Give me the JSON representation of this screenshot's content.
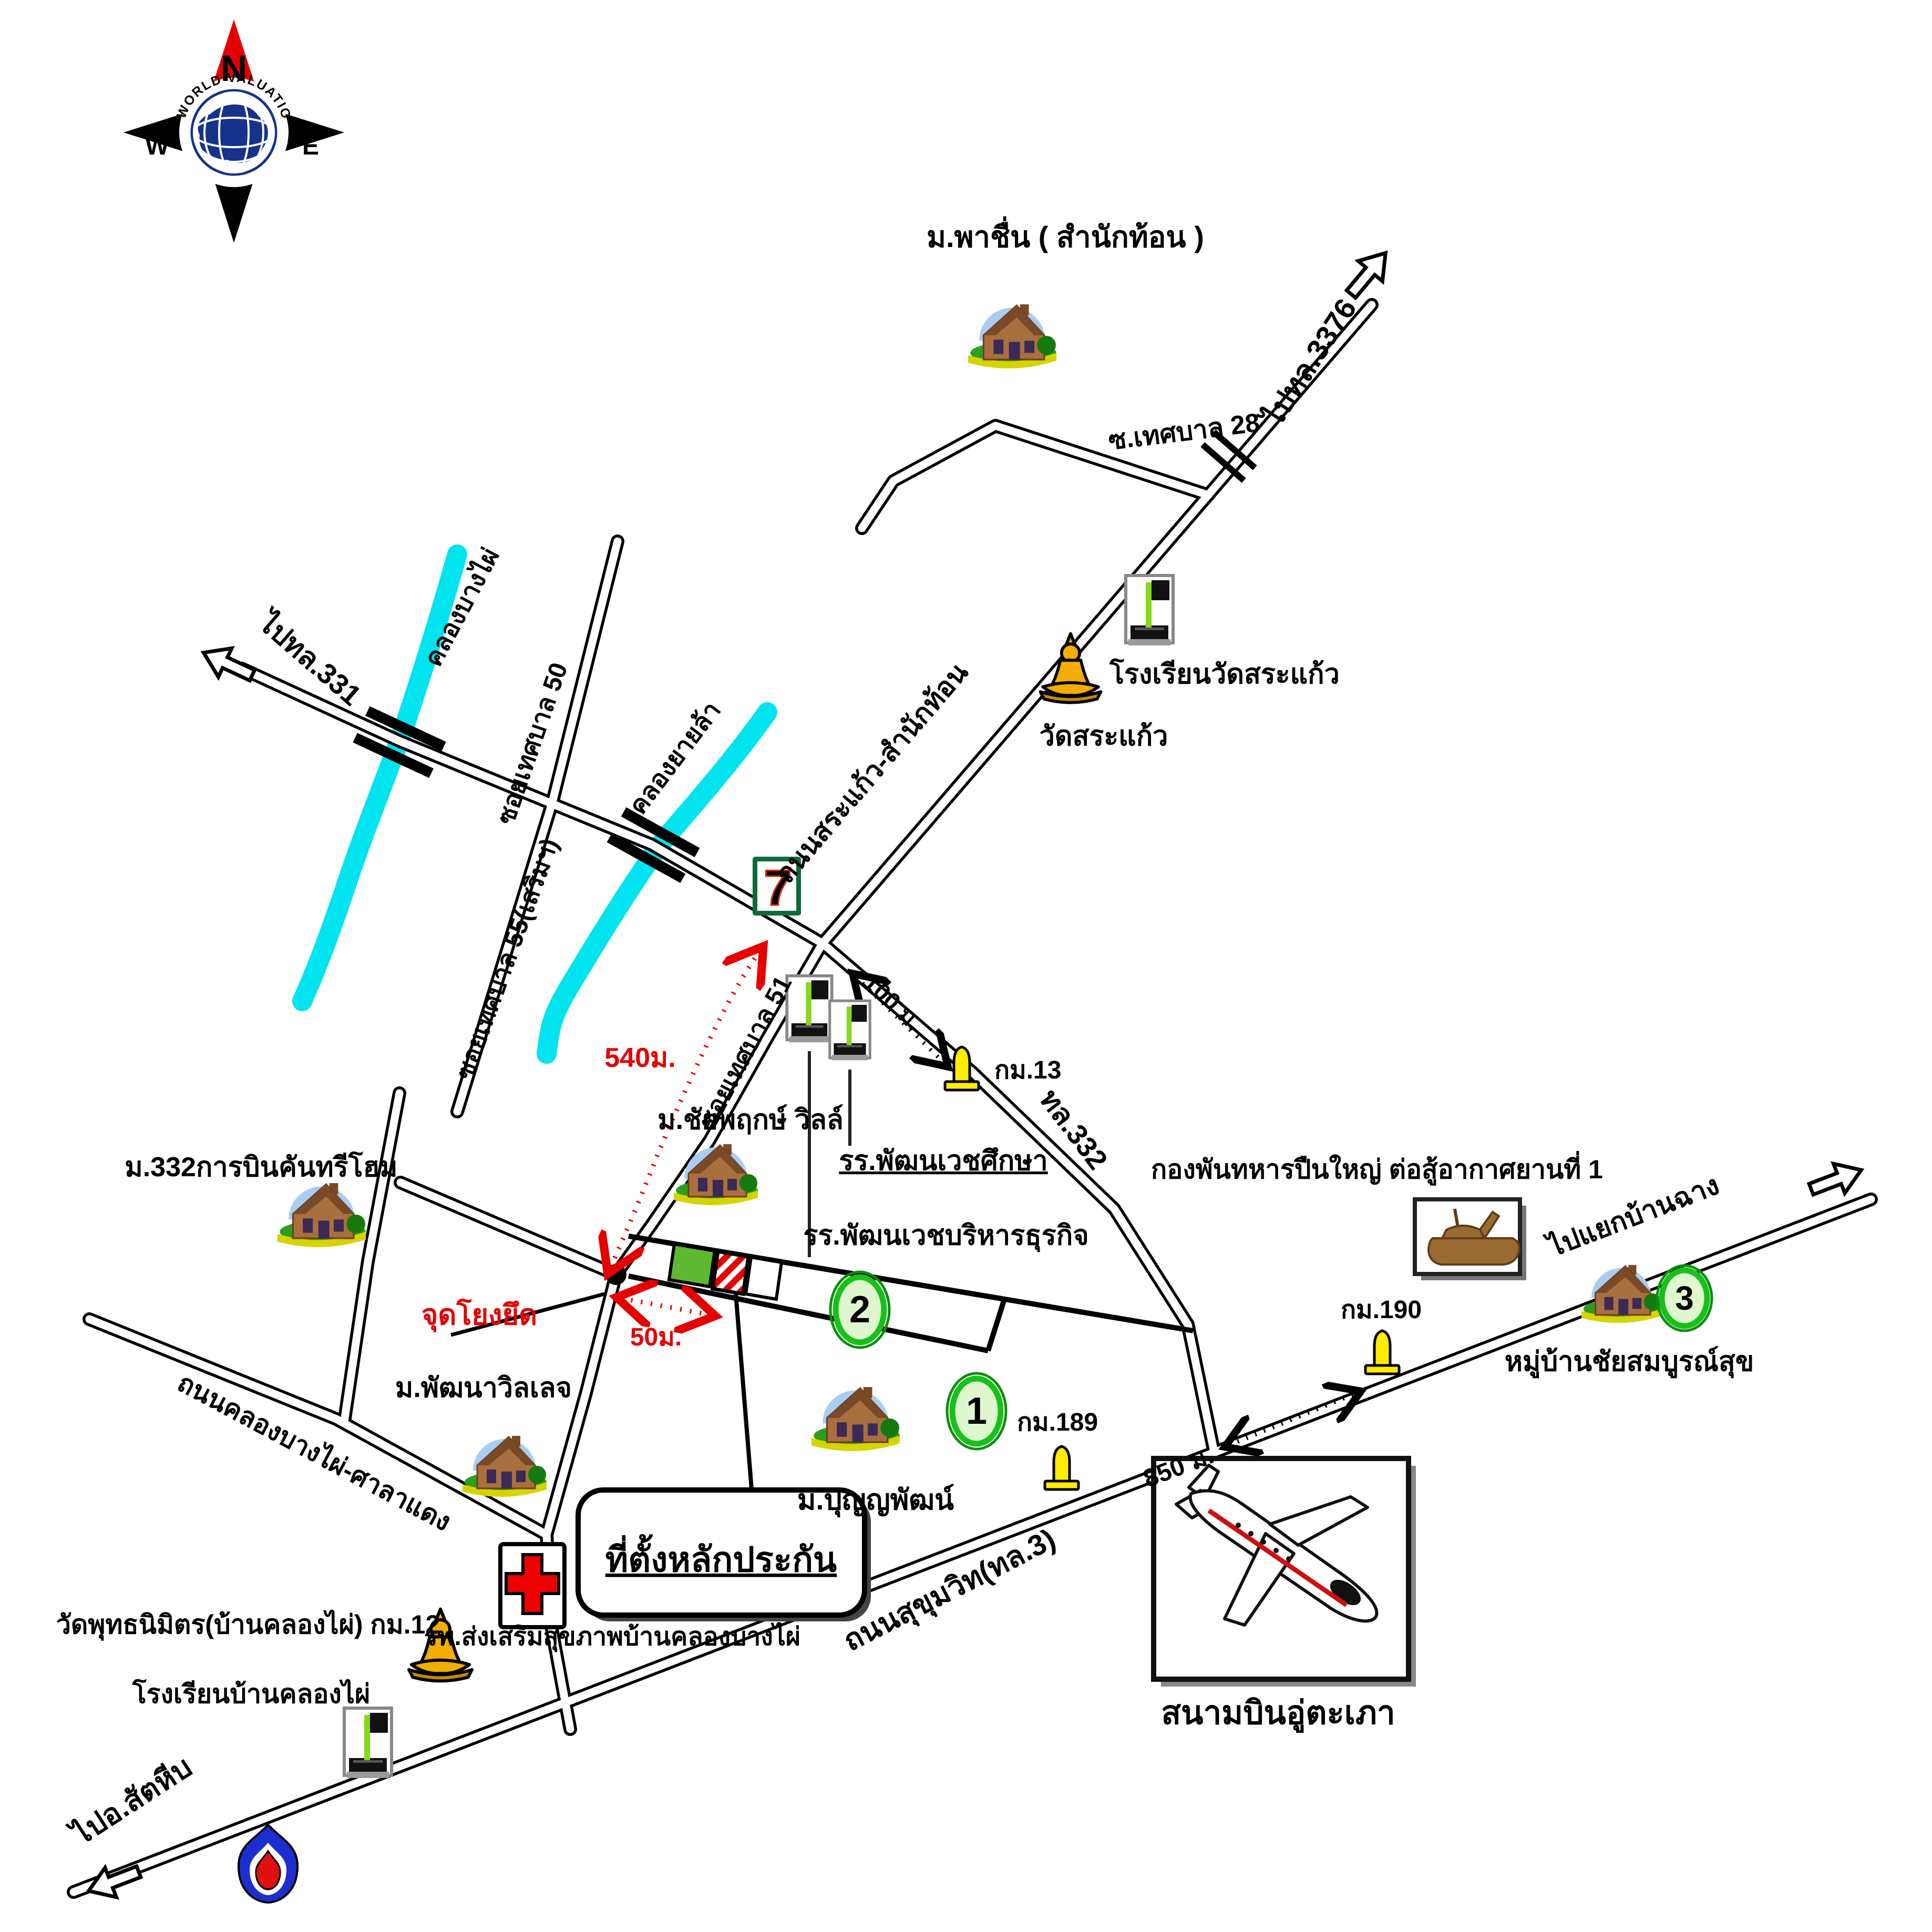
{
  "compass": {
    "north": "N",
    "east": "E",
    "south": "S",
    "west": "W",
    "brand": "WORLD VALUATION"
  },
  "places": {
    "pachuen": "ม.พาชื่น ( สำนักท้อน )",
    "school_wat_sakaeo": "โรงเรียนวัดสระแก้ว",
    "wat_sakaeo": "วัดสระแก้ว",
    "chaiyapruek_ville": "ม.ชัยพฤกษ์ วิลล์",
    "pattanawet_suksa": "รร.พัฒนเวชศึกษา",
    "pattanawet_biz": "รร.พัฒนเวชบริหารธุรกิจ",
    "m332_country_home": "ม.332การบินคันทรีโฮม",
    "punyapat": "ม.ปุญญพัฒน์",
    "artillery_batt": "กองพันทหารปืนใหญ่ ต่อสู้อากาศยานที่ 1",
    "chaisomboonsuk": "หมู่บ้านชัยสมบูรณ์สุข",
    "pattana_village": "ม.พัฒนาวิลเลจ",
    "hospital": "รพ.ส่งเสริมสุขภาพบ้านคลองบางไผ่",
    "utapao": "สนามบินอู่ตะเภา",
    "wat_buddhanimit": "วัดพุทธนิมิตร(บ้านคลองไผ่) กม.12",
    "school_ban_khlong_phai": "โรงเรียนบ้านคลองไผ่",
    "subject": "ที่ตั้งหลักประกัน",
    "anchor_point": "จุดโยงยึด"
  },
  "roads": {
    "sakaeo_samnak_thon": "ถนนสระแก้ว-สำนักท้อน",
    "soi_28": "ซ.เทศบาล 28",
    "to_3376": "ไปทล.3376",
    "to_331": "ไปทล.331",
    "soi_50": "ซอยเทศบาล 50",
    "soi_55": "ซอยเทศบาล 55(เสริมฯ)",
    "soi_51": "ซอยเทศบาล 51",
    "hwy_332": "ทล.332",
    "khlong_bang_phai_road": "ถนนคลองบางไผ่-ศาลาแดง",
    "sukhumvit": "ถนนสุขุมวิท(ทล.3)",
    "to_ban_chang": "ไปแยกบ้านฉาง",
    "to_sattahip": "ไปอ.สัตหีบ"
  },
  "canals": {
    "bang_phai": "คลองบางไผ่",
    "yai_la": "คลองยายล้า"
  },
  "distances": {
    "d100": "100 ม.",
    "d540": "540ม.",
    "d50": "50ม.",
    "d850": "850 ม."
  },
  "km_markers": {
    "km13": "กม.13",
    "km189": "กม.189",
    "km190": "กม.190"
  },
  "badges": {
    "n1": "1",
    "n2": "2",
    "n3": "3",
    "seven": "7"
  },
  "colors": {
    "road": "#000000",
    "canal": "#00e4f0",
    "highlight_red": "#e60000",
    "parcel_green": "#5fb832",
    "circle_green": "#17c11a",
    "marker_yellow": "#ffec00",
    "compass_red": "#e40000",
    "globe_blue": "#16328c",
    "seven_green": "#0e6b38",
    "seven_orange": "#f97306"
  }
}
